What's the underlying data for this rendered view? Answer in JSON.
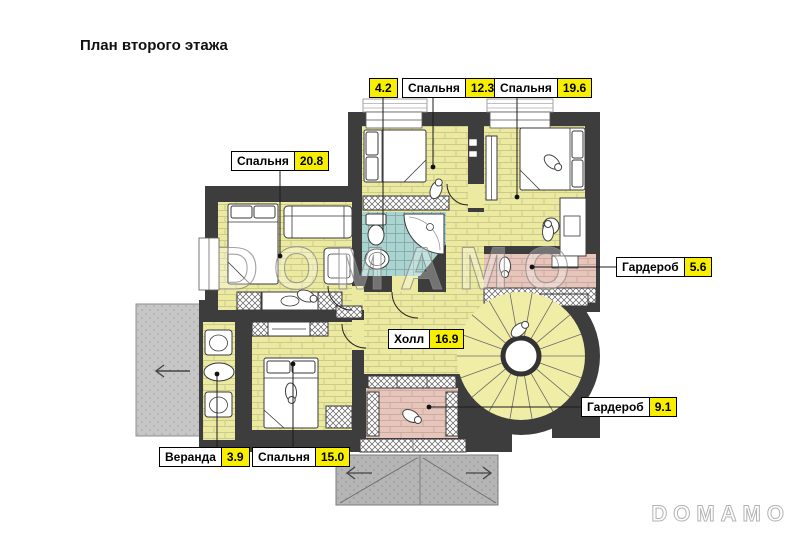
{
  "title": "План второго этажа",
  "watermark": {
    "large": "DOMAMO",
    "small": "DOMAMO"
  },
  "rooms": {
    "bathroom": {
      "name": "",
      "area": "4.2"
    },
    "bedroom1": {
      "name": "Спальня",
      "area": "12.3"
    },
    "bedroom2": {
      "name": "Спальня",
      "area": "19.6"
    },
    "bedroom3": {
      "name": "Спальня",
      "area": "20.8"
    },
    "wardrobe1": {
      "name": "Гардероб",
      "area": "5.6"
    },
    "hall": {
      "name": "Холл",
      "area": "16.9"
    },
    "wardrobe2": {
      "name": "Гардероб",
      "area": "9.1"
    },
    "veranda": {
      "name": "Веранда",
      "area": "3.9"
    },
    "bedroom4": {
      "name": "Спальня",
      "area": "15.0"
    }
  },
  "colors": {
    "wall": "#3d3d3d",
    "floor_yellow": "#ece9a0",
    "floor_pink": "#e8c5bb",
    "floor_blue": "#abd4d1",
    "terrace_gray": "#c6c6c6",
    "roof_gray": "#b5b5b5",
    "label_value_bg": "#f8ee00"
  }
}
